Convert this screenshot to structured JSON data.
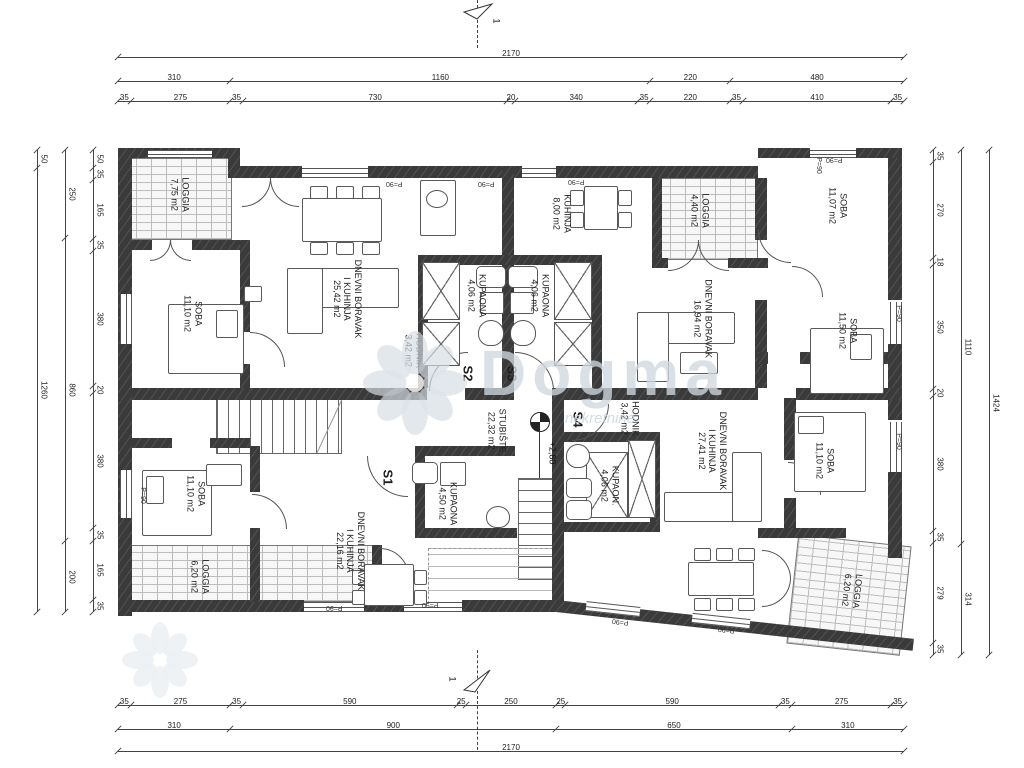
{
  "plan": {
    "watermark": {
      "brand": "Dogma",
      "sub": "nekretnine"
    },
    "elevation": "+2,80",
    "section_label": "1",
    "marks": {
      "parapet": "P=90"
    },
    "units": [
      "S1",
      "S2",
      "S3",
      "S4"
    ],
    "rooms": [
      {
        "name": "LOGGIA",
        "area": "7,75 m2"
      },
      {
        "name": "SOBA",
        "area": "11,10 m2"
      },
      {
        "name": "DNEVNI BORAVAK\nI KUHINJA",
        "area": "25,42 m2"
      },
      {
        "name": "HODNIK",
        "area": "3,42 m2"
      },
      {
        "name": "KUPAONA",
        "area": "4,06 m2"
      },
      {
        "name": "KUPAONA",
        "area": "4,06 m2"
      },
      {
        "name": "KUHINJA",
        "area": "8,00 m2"
      },
      {
        "name": "LOGGIA",
        "area": "4,40 m2"
      },
      {
        "name": "SOBA",
        "area": "11,07 m2"
      },
      {
        "name": "DNEVNI BORAVAK",
        "area": "16,94 m2"
      },
      {
        "name": "SOBA",
        "area": "11,50 m2"
      },
      {
        "name": "STUBIŠTE",
        "area": "22,32 m2"
      },
      {
        "name": "HODNIK",
        "area": "3,42 m2"
      },
      {
        "name": "KUPAON.",
        "area": "4,06 m2"
      },
      {
        "name": "DNEVNI BORAVAK\nI KUHINJA",
        "area": "27,41 m2"
      },
      {
        "name": "SOBA",
        "area": "11,10 m2"
      },
      {
        "name": "LOGGIA",
        "area": "6,20 m2"
      },
      {
        "name": "KUPAONA",
        "area": "4,50 m2"
      },
      {
        "name": "SOBA",
        "area": "11,10 m2"
      },
      {
        "name": "DNEVNI BORAVAK\nI KUHINJA",
        "area": "22,16 m2"
      },
      {
        "name": "LOGGIA",
        "area": "6,20 m2"
      }
    ],
    "dimensions": {
      "top": [
        [
          2170
        ],
        [
          310,
          1160,
          220,
          480
        ],
        [
          35,
          275,
          35,
          730,
          20,
          340,
          35,
          220,
          35,
          410,
          35
        ]
      ],
      "bottom": [
        [
          35,
          275,
          35,
          590,
          25,
          250,
          25,
          590,
          35,
          275,
          35
        ],
        [
          310,
          900,
          650,
          310
        ],
        [
          2170
        ]
      ],
      "left": [
        [
          50,
          1260
        ],
        [
          250,
          860,
          200
        ],
        [
          50,
          35,
          165,
          35,
          380,
          20,
          380,
          35,
          165,
          35
        ]
      ],
      "right": [
        [
          35,
          270,
          18,
          350,
          20,
          380,
          35,
          279,
          35
        ],
        [
          1110,
          314
        ],
        [
          1424
        ]
      ]
    }
  }
}
